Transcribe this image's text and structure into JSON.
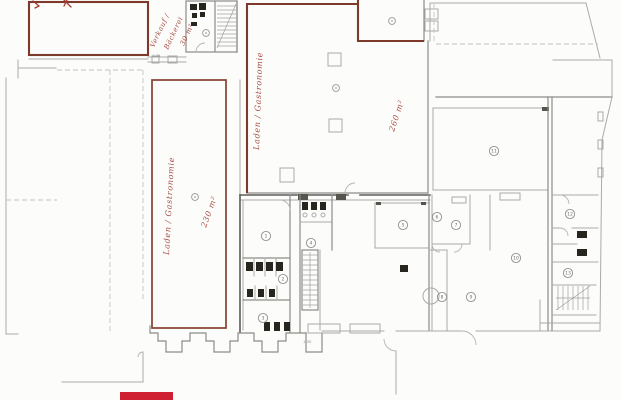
{
  "colors": {
    "background": "#fcfcfa",
    "wall_gray_light": "#aaaaa8",
    "wall_gray_dark": "#5d5d5b",
    "room_outline_red": "#7d3a2b",
    "annotation_red": "#9c3a31",
    "highlight_red": "#ce2030",
    "fixture_black": "#26261f"
  },
  "annotations": [
    {
      "id": "verkauf-line1",
      "text": "Verkauf /"
    },
    {
      "id": "verkauf-line2",
      "text": "Bäckerei"
    },
    {
      "id": "verkauf-area",
      "text": "30 m²"
    },
    {
      "id": "central-room-label",
      "text": "Laden / Gastronomie"
    },
    {
      "id": "central-room-area",
      "text": "260 m²"
    },
    {
      "id": "left-room-label",
      "text": "Laden / Gastronomie"
    },
    {
      "id": "left-room-area",
      "text": "230 m²"
    }
  ],
  "room_markers": [
    {
      "n": "1",
      "x": 266,
      "y": 236
    },
    {
      "n": "2",
      "x": 283,
      "y": 279
    },
    {
      "n": "3",
      "x": 263,
      "y": 318
    },
    {
      "n": "4",
      "x": 311,
      "y": 243
    },
    {
      "n": "5",
      "x": 403,
      "y": 225
    },
    {
      "n": "6",
      "x": 437,
      "y": 217
    },
    {
      "n": "7",
      "x": 456,
      "y": 225
    },
    {
      "n": "8",
      "x": 442,
      "y": 297
    },
    {
      "n": "9",
      "x": 471,
      "y": 297
    },
    {
      "n": "10",
      "x": 516,
      "y": 258
    },
    {
      "n": "11",
      "x": 494,
      "y": 151
    },
    {
      "n": "12",
      "x": 570,
      "y": 214
    },
    {
      "n": "13",
      "x": 568,
      "y": 273
    }
  ],
  "symbol_points": [
    {
      "x": 206,
      "y": 33
    },
    {
      "x": 336,
      "y": 88
    },
    {
      "x": 392,
      "y": 21
    },
    {
      "x": 195,
      "y": 197
    }
  ],
  "dimensions": [
    {
      "text": "1.35",
      "x": 152,
      "y": 57
    },
    {
      "text": "1.30",
      "x": 303,
      "y": 343
    }
  ]
}
